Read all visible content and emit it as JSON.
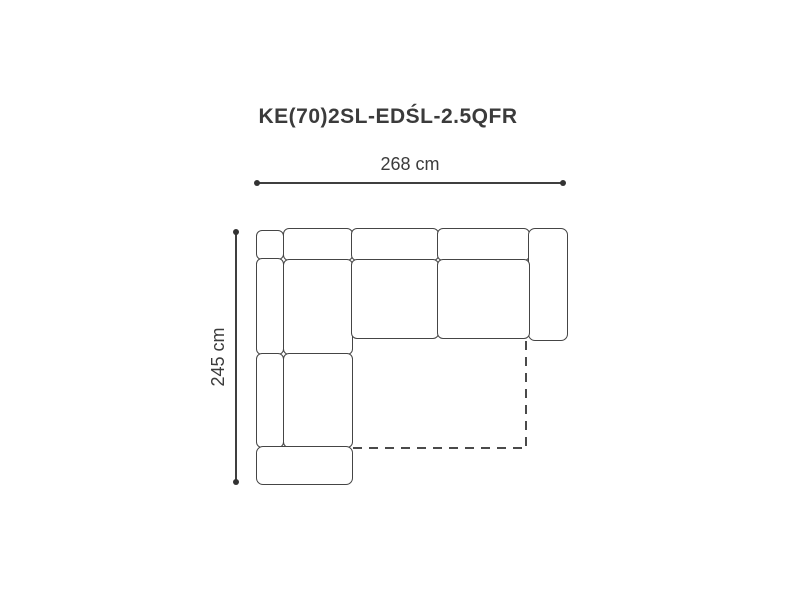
{
  "title": "KE(70)2SL-EDŚL-2.5QFR",
  "dimensions": {
    "width_label": "268 cm",
    "depth_label": "245 cm"
  },
  "colors": {
    "background": "#ffffff",
    "outline": "#454545",
    "dimension_line": "#3f3f3f",
    "text": "#3b3b3b"
  },
  "diagram": {
    "kind": "corner-sofa-top-view",
    "bed_outline_style": "dashed",
    "pieces": [
      "corner-back-block",
      "left-backrest-upper",
      "left-backrest-lower",
      "corner-back-cushion",
      "back-cushion-1",
      "back-cushion-2",
      "right-armrest",
      "corner-seat-upper",
      "corner-seat-lower",
      "seat-1",
      "seat-2",
      "front-armrest"
    ]
  }
}
